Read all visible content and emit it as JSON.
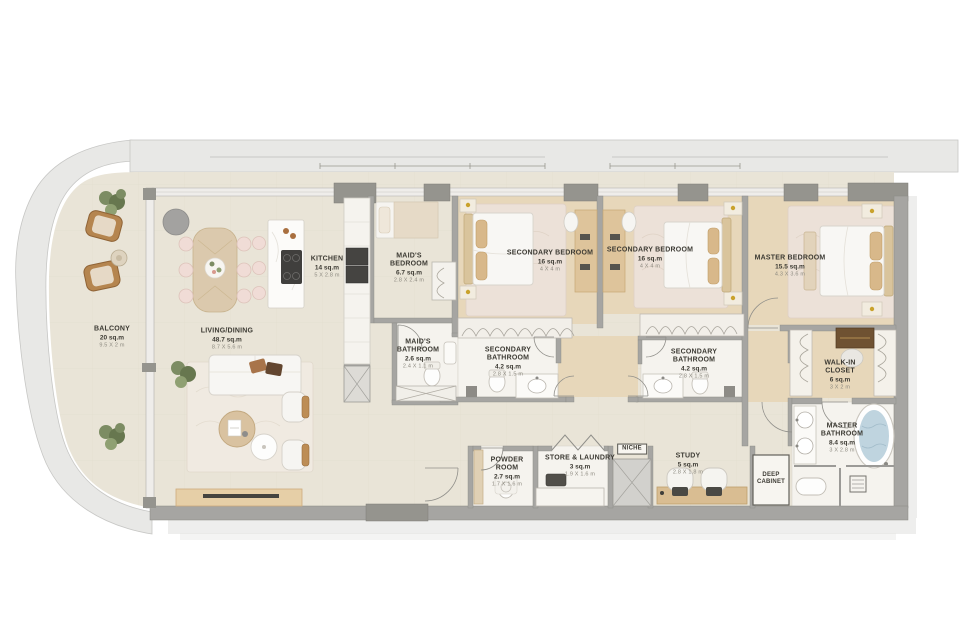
{
  "plan_title": "3-bedroom apartment floor plan",
  "rooms": [
    {
      "id": "balcony",
      "name": "BALCONY",
      "area": "20 sq.m",
      "dims": "9.5 X 2 m"
    },
    {
      "id": "living_dining",
      "name": "LIVING/DINING",
      "area": "48.7 sq.m",
      "dims": "8.7 X 5.6 m"
    },
    {
      "id": "kitchen",
      "name": "KITCHEN",
      "area": "14 sq.m",
      "dims": "5 X 2.8 m"
    },
    {
      "id": "maids_bedroom",
      "name": "MAID'S BEDROOM",
      "area": "6.7 sq.m",
      "dims": "2.8 X 2.4 m"
    },
    {
      "id": "maids_bathroom",
      "name": "MAID'S BATHROOM",
      "area": "2.6 sq.m",
      "dims": "2.4 X 1.1 m"
    },
    {
      "id": "secondary_bedroom_1",
      "name": "SECONDARY BEDROOM",
      "area": "16 sq.m",
      "dims": "4 X 4 m"
    },
    {
      "id": "secondary_bathroom_1",
      "name": "SECONDARY BATHROOM",
      "area": "4.2 sq.m",
      "dims": "2.8 X 1.5 m"
    },
    {
      "id": "secondary_bedroom_2",
      "name": "SECONDARY BEDROOM",
      "area": "16 sq.m",
      "dims": "4 X 4 m"
    },
    {
      "id": "secondary_bathroom_2",
      "name": "SECONDARY BATHROOM",
      "area": "4.2 sq.m",
      "dims": "2.8 X 1.5 m"
    },
    {
      "id": "master_bedroom",
      "name": "MASTER BEDROOM",
      "area": "15.5 sq.m",
      "dims": "4.3 X 3.6 m"
    },
    {
      "id": "walk_in_closet",
      "name": "WALK-IN CLOSET",
      "area": "6 sq.m",
      "dims": "3 X 2 m"
    },
    {
      "id": "master_bathroom",
      "name": "MASTER BATHROOM",
      "area": "8.4 sq.m",
      "dims": "3 X 2.8 m"
    },
    {
      "id": "powder_room",
      "name": "POWDER ROOM",
      "area": "2.7 sq.m",
      "dims": "1.7 X 1.6 m"
    },
    {
      "id": "store_laundry",
      "name": "STORE & LAUNDRY",
      "area": "3 sq.m",
      "dims": "1.9 X 1.6 m"
    },
    {
      "id": "study",
      "name": "STUDY",
      "area": "5 sq.m",
      "dims": "2.8 X 1.8 m"
    },
    {
      "id": "deep_cabinet",
      "name": "DEEP CABINET"
    },
    {
      "id": "niche",
      "name": "NICHE"
    }
  ],
  "colors": {
    "wall_gray": "#a6a5a2",
    "column_gray": "#95948e",
    "facade_band": "#e8e8e6",
    "floor_cream": "#e9e4d7",
    "floor_wood": "#e7d7ba",
    "bath_white": "#f5f3ee",
    "rug": "#ece1d8",
    "accent_wood": "#c8a06a",
    "tub_water": "#bfd4df",
    "label_text": "#3c3a33",
    "dims_text": "#8d8a80"
  }
}
